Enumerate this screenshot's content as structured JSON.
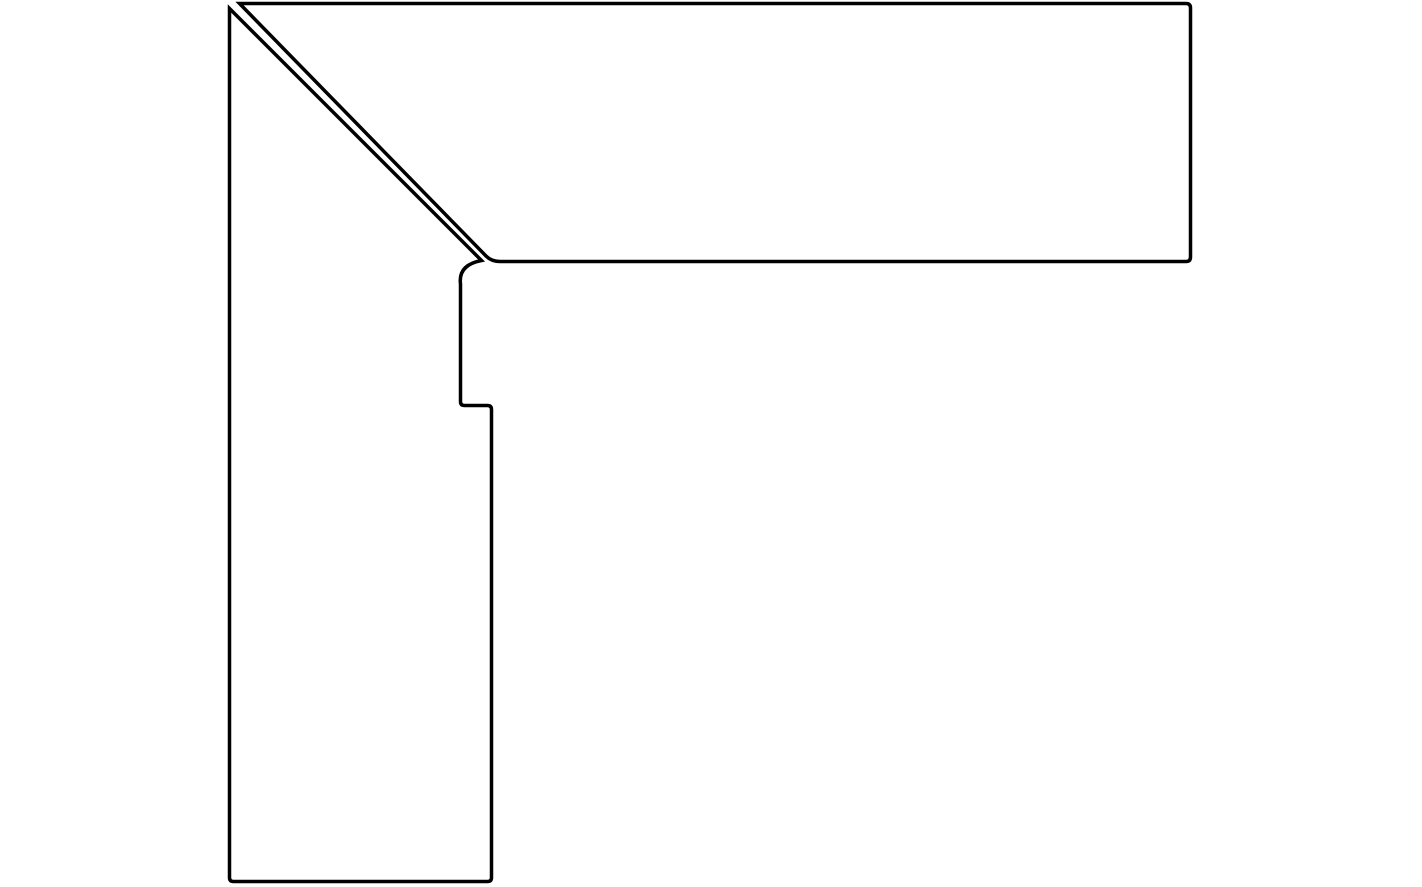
{
  "page": {
    "background_color": "#ffffff"
  },
  "drawing": {
    "name": "mitred-corner-profile-drawing",
    "description": "Line drawing of a two-piece corner assembly: a vertical board and a horizontal board joined by a 45-degree mitre at the top-left, drawn as black outlines on white",
    "stroke_color": "#000000",
    "fill_color": "#ffffff",
    "stroke_width": "3.5",
    "viewBox": "0 0 1422 887",
    "pieces": [
      {
        "label": "horizontal-board",
        "path": "M 239.5 3.5 L 1186 3.5 Q 1190.5 3.5 1190.5 8 L 1190.5 257 Q 1190.5 261.5 1186 261.5 L 500 261.5 Q 491.5 261.5 486 256 L 239.5 3.5 Z"
      },
      {
        "label": "vertical-board",
        "path": "M 229.5 8.5 L 481.5 260.5 Q 458 265 460.5 284 L 460.5 401.5 Q 460.5 405.5 464.5 405.5 L 487.5 405.5 Q 491.5 405.5 491.5 409.5 L 491.5 877.5 Q 491.5 881.5 487.5 881.5 L 233.5 881.5 Q 229.5 881.5 229.5 877.5 L 229.5 8.5 Z"
      }
    ]
  }
}
